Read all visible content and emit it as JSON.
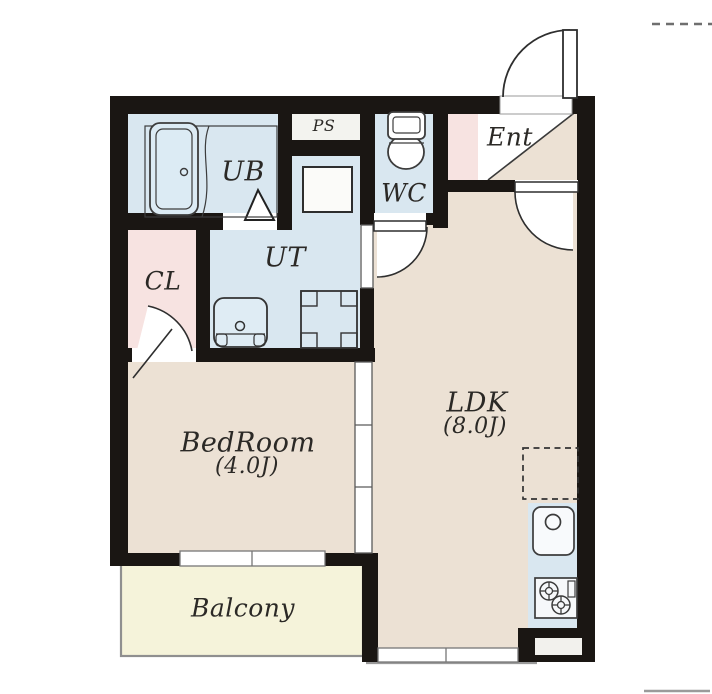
{
  "plan_title": "1LDK apartment floor plan",
  "rooms": {
    "ub": {
      "label": "UB"
    },
    "ps": {
      "label": "PS"
    },
    "wc": {
      "label": "WC"
    },
    "ent": {
      "label": "Ent"
    },
    "ut": {
      "label": "UT"
    },
    "cl": {
      "label": "CL"
    },
    "bedroom": {
      "label": "BedRoom",
      "area": "(4.0J)"
    },
    "ldk": {
      "label": "LDK",
      "area": "(8.0J)"
    },
    "balcony": {
      "label": "Balcony"
    }
  },
  "fixtures": [
    "bathtub",
    "toilet",
    "washing-machine-pan",
    "vanity-basin",
    "storage-box",
    "kitchen-sink",
    "gas-stove",
    "refrigerator-space",
    "entrance-door",
    "ldk-door",
    "wc-door",
    "closet-door",
    "bathroom-folding-door",
    "sliding-partition",
    "windows"
  ],
  "colors": {
    "wall": "#1a1613",
    "floor_beige": "#ece1d4",
    "wet_area_blue": "#d9e7f0",
    "closet_pink": "#f7e3e1",
    "balcony_cream": "#f5f3da",
    "fixture_white": "#ffffff",
    "outline_gray": "#8f8f8f"
  }
}
